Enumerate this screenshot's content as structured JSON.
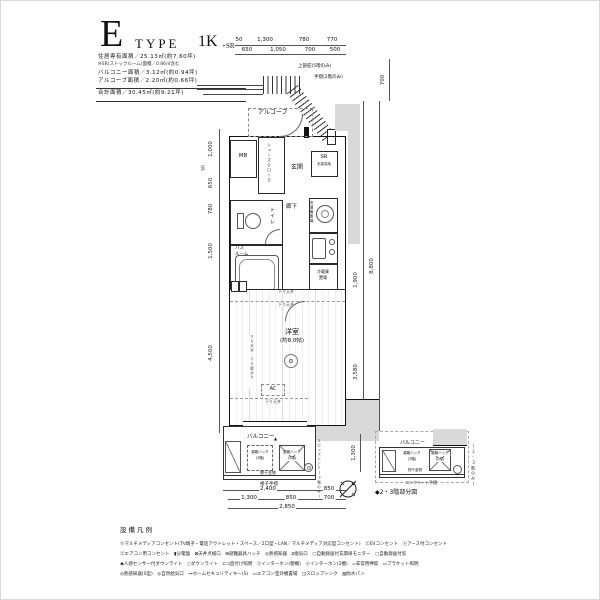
{
  "title": {
    "letter": "E",
    "word": "TYPE",
    "plan": "1K",
    "plan_suffix": "+SR",
    "specs": [
      "住居専有面積／25.13㎡(約7.60坪)",
      "※SR(ストックルーム)面積／0.86㎡含む",
      "バルコニー面積／3.12㎡(約0.94坪)",
      "アルコーブ面積／2.20㎡(約0.66坪)"
    ],
    "total": "合計面積／30.45㎡(約9.21坪)"
  },
  "annotations": {
    "eaves": "上部庇(5階のみ)",
    "handrail": "手摺(2階のみ)"
  },
  "rooms": {
    "alcove": "アルコーブ",
    "mb": "MB",
    "entrance": "玄関",
    "shoes": "シューズクローク",
    "sr": "SR",
    "sr_sub": "天袋収納",
    "toilet": "トイレ",
    "bath_l1": "バス",
    "bath_l2": "ルーム",
    "hall": "廊下",
    "washer": "洗濯機置場",
    "fridge_l1": "冷蔵庫",
    "fridge_l2": "置場",
    "main": "洋室",
    "main_size": "(約8.0帖)",
    "ac": "AC",
    "down_ceiling": "下り天井",
    "wall_note": "下り天井・下り壁あり"
  },
  "balcony": {
    "label": "バルコニー",
    "hatch_l1": "避難ハッチ",
    "hatch3": "(3階)",
    "hatch2": "(2階)",
    "pole": "物干金物",
    "rail": "格子手摺",
    "slop": "スロップシンク(3階のみ)",
    "marker": "▲",
    "dim": "1,300"
  },
  "subplan": {
    "label": "バルコニー",
    "hatch_l1": "避難ハッチ",
    "hatch3": "(3階)",
    "hatch2": "(2階)",
    "pole": "物干金物",
    "rail": "コンクリート手摺",
    "side": "(2・3階のみ)",
    "caption": "◆2・3階部分図"
  },
  "dims": {
    "top1": [
      "50",
      "1,300",
      "780",
      "770"
    ],
    "top2": [
      "650",
      "1,050",
      "700",
      "500"
    ],
    "top_right": "700",
    "left": [
      "1,000",
      "50",
      "650",
      "780",
      "1,500",
      "4,500"
    ],
    "right": [
      "700",
      "700",
      "1,050",
      "730",
      "1,900",
      "3,580"
    ],
    "right_total": "8,800",
    "bottom1": [
      "2,400",
      "850"
    ],
    "bottom2": [
      "1,300",
      "850",
      "700"
    ],
    "bottom3": "2,850"
  },
  "legend": {
    "header": "設備凡例",
    "rows": [
      "㋮マルチメディアコンセント(TV端子・電話アウトレット・スペース／2口型・LAN／マルチメディア対応型コンセント)　㋓EVコンセント　㋣アース付コンセント",
      "㋓エアコン用コンセント　▮分電盤　⊠天井点検口　⊞避難器具ハッチ　◎熱感知器　⧄換気口　▢自動録画付玄関扉モニター　▢自動録画付窓",
      "◉人感センサー付ダウンライト　○ダウンライト　⊏⊐直付け照明　㋑インターホン(親機)　㋑インターホン(2機)　▱非常用押釦　▭ブラケット照明",
      "◎熱感知器(S型)　◎自然給気口　⊶ホームセキュリティキー(S)　▭エアコン室外機置場　◫スロップシンク　▨防水パン"
    ]
  }
}
